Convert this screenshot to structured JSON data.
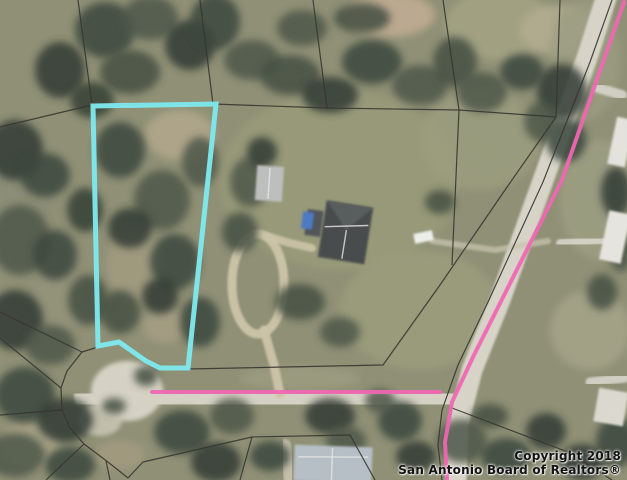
{
  "canvas": {
    "width": 627,
    "height": 480
  },
  "colors": {
    "terrain_base": "#8e8f74",
    "subject_lot_outline": "#7de9ee",
    "road_highlight": "#f264b4",
    "parcel_line": "#33332c",
    "credit_text": "#141414"
  },
  "credit": {
    "line1": "Copyright 2018",
    "line2": "San Antonio Board of Realtors®"
  },
  "terrain": {
    "base": "#8e8f74",
    "patches": [
      [
        390,
        15,
        45,
        22,
        "#c0ab92",
        0.9
      ],
      [
        500,
        25,
        55,
        35,
        "#a3a283",
        0.9
      ],
      [
        560,
        30,
        40,
        25,
        "#b5ad92",
        0.8
      ],
      [
        340,
        180,
        120,
        90,
        "#979a78",
        0.9
      ],
      [
        420,
        310,
        80,
        60,
        "#9a9c7c",
        0.85
      ],
      [
        480,
        140,
        60,
        50,
        "#9b9d7e",
        0.8
      ],
      [
        180,
        135,
        35,
        25,
        "#b3a78c",
        0.85
      ],
      [
        135,
        265,
        28,
        38,
        "#a29b80",
        0.8
      ],
      [
        165,
        325,
        22,
        18,
        "#a89f84",
        0.8
      ],
      [
        600,
        200,
        40,
        60,
        "#9c9e81",
        0.85
      ],
      [
        585,
        60,
        35,
        60,
        "#9a9c80",
        0.8
      ],
      [
        590,
        330,
        40,
        40,
        "#a5a387",
        0.85
      ],
      [
        30,
        445,
        30,
        25,
        "#b0a88c",
        0.7
      ],
      [
        120,
        455,
        25,
        15,
        "#ab9f84",
        0.6
      ],
      [
        25,
        190,
        30,
        40,
        "#8a8c74",
        0.9
      ],
      [
        60,
        300,
        25,
        30,
        "#94937a",
        0.8
      ],
      [
        300,
        378,
        60,
        12,
        "#9f9e82",
        0.7
      ]
    ],
    "tree_colors": [
      "#39443a",
      "#2e3730",
      "#4b5546",
      "#57604c",
      "#424d40",
      "#333d33",
      "#5f6852"
    ],
    "trees": [
      [
        15,
        150,
        28,
        30,
        1
      ],
      [
        45,
        175,
        25,
        22,
        0
      ],
      [
        20,
        240,
        30,
        35,
        2
      ],
      [
        55,
        255,
        22,
        25,
        0
      ],
      [
        15,
        320,
        28,
        30,
        1
      ],
      [
        50,
        345,
        25,
        20,
        2
      ],
      [
        25,
        395,
        30,
        28,
        0
      ],
      [
        65,
        420,
        28,
        22,
        1
      ],
      [
        15,
        455,
        30,
        22,
        2
      ],
      [
        70,
        465,
        25,
        18,
        0
      ],
      [
        88,
        300,
        20,
        25,
        4
      ],
      [
        85,
        210,
        18,
        22,
        5
      ],
      [
        105,
        30,
        30,
        28,
        0
      ],
      [
        150,
        18,
        28,
        22,
        2
      ],
      [
        190,
        45,
        25,
        25,
        1
      ],
      [
        130,
        72,
        30,
        22,
        4
      ],
      [
        215,
        22,
        25,
        28,
        0
      ],
      [
        252,
        60,
        28,
        20,
        2
      ],
      [
        60,
        70,
        25,
        28,
        1
      ],
      [
        92,
        100,
        22,
        18,
        5
      ],
      [
        290,
        75,
        30,
        20,
        4
      ],
      [
        330,
        95,
        28,
        18,
        1
      ],
      [
        372,
        62,
        30,
        22,
        0
      ],
      [
        420,
        85,
        28,
        20,
        2
      ],
      [
        455,
        62,
        22,
        25,
        4
      ],
      [
        302,
        28,
        25,
        18,
        2
      ],
      [
        362,
        18,
        28,
        15,
        4
      ],
      [
        120,
        150,
        25,
        28,
        0
      ],
      [
        162,
        200,
        28,
        30,
        2
      ],
      [
        130,
        228,
        22,
        20,
        1
      ],
      [
        175,
        262,
        25,
        28,
        0
      ],
      [
        120,
        312,
        20,
        22,
        4
      ],
      [
        160,
        296,
        18,
        18,
        1
      ],
      [
        200,
        162,
        18,
        25,
        2
      ],
      [
        200,
        322,
        20,
        25,
        0
      ],
      [
        250,
        182,
        20,
        25,
        2
      ],
      [
        240,
        232,
        18,
        20,
        4
      ],
      [
        300,
        302,
        25,
        18,
        4
      ],
      [
        340,
        332,
        20,
        15,
        2
      ],
      [
        262,
        152,
        15,
        15,
        1
      ],
      [
        440,
        202,
        15,
        12,
        4
      ],
      [
        482,
        92,
        25,
        20,
        2
      ],
      [
        522,
        72,
        22,
        18,
        0
      ],
      [
        562,
        92,
        25,
        28,
        1
      ],
      [
        566,
        140,
        20,
        22,
        0
      ],
      [
        542,
        122,
        18,
        20,
        2
      ],
      [
        616,
        192,
        15,
        25,
        1
      ],
      [
        621,
        252,
        12,
        20,
        2
      ],
      [
        602,
        292,
        15,
        18,
        4
      ],
      [
        616,
        442,
        20,
        25,
        0
      ],
      [
        582,
        462,
        22,
        18,
        1
      ],
      [
        182,
        432,
        28,
        22,
        0
      ],
      [
        232,
        416,
        22,
        18,
        2
      ],
      [
        216,
        462,
        25,
        20,
        1
      ],
      [
        270,
        456,
        20,
        15,
        0
      ],
      [
        330,
        416,
        25,
        18,
        1
      ],
      [
        346,
        441,
        20,
        15,
        2
      ],
      [
        400,
        421,
        22,
        20,
        0
      ],
      [
        416,
        456,
        20,
        15,
        1
      ],
      [
        462,
        441,
        25,
        22,
        2
      ],
      [
        506,
        456,
        25,
        18,
        0
      ],
      [
        546,
        431,
        20,
        18,
        1
      ],
      [
        490,
        416,
        18,
        12,
        4
      ],
      [
        380,
        401,
        15,
        12,
        2
      ],
      [
        146,
        376,
        12,
        10,
        4
      ],
      [
        114,
        406,
        12,
        8,
        4
      ]
    ]
  },
  "roads": {
    "bulbs": [
      {
        "cx": 127,
        "cy": 391,
        "rx": 36,
        "ry": 30,
        "fill": "#d6d2c4",
        "opacity": 1
      },
      {
        "cx": 100,
        "cy": 420,
        "rx": 22,
        "ry": 16,
        "fill": "#cfcaba",
        "opacity": 0.8
      }
    ],
    "strips": [
      {
        "points": [
          [
            96,
            396
          ],
          [
            240,
            396
          ],
          [
            370,
            398
          ],
          [
            446,
            402
          ]
        ],
        "width": 44,
        "color": "#d6d2c4",
        "opacity": 1
      },
      {
        "points": [
          [
            607,
            -5
          ],
          [
            588,
            55
          ],
          [
            545,
            175
          ],
          [
            500,
            300
          ],
          [
            472,
            370
          ],
          [
            458,
            425
          ],
          [
            456,
            482
          ]
        ],
        "width": 21,
        "color": "#d8d4c8",
        "opacity": 1
      },
      {
        "points": [
          [
            264,
            330
          ],
          [
            274,
            365
          ],
          [
            280,
            394
          ]
        ],
        "width": 9,
        "color": "#cdc5a9",
        "opacity": 0.95
      },
      {
        "points": [
          [
            266,
            236
          ],
          [
            290,
            243
          ],
          [
            312,
            248
          ]
        ],
        "width": 8,
        "color": "#cdc5a9",
        "opacity": 0.9
      },
      {
        "points": [
          [
            548,
            241
          ],
          [
            495,
            250
          ],
          [
            432,
            241
          ]
        ],
        "width": 6,
        "color": "#c9c3ae",
        "opacity": 0.75
      },
      {
        "points": [
          [
            598,
            88
          ],
          [
            622,
            95
          ]
        ],
        "width": 10,
        "color": "#d9d6cc",
        "opacity": 0.9
      },
      {
        "points": [
          [
            560,
            243
          ],
          [
            605,
            240
          ]
        ],
        "width": 8,
        "color": "#d9d6cc",
        "opacity": 0.9
      },
      {
        "points": [
          [
            590,
            382
          ],
          [
            625,
            378
          ]
        ],
        "width": 9,
        "color": "#d9d6cc",
        "opacity": 0.9
      },
      {
        "points": [
          [
            285,
            445
          ],
          [
            290,
            480
          ]
        ],
        "width": 12,
        "color": "#cfc8b4",
        "opacity": 0.85
      }
    ],
    "rings": [
      {
        "cx": 258,
        "cy": 284,
        "rx": 26,
        "ry": 50,
        "width": 9,
        "color": "#cdc5a9",
        "opacity": 0.95
      }
    ]
  },
  "buildings": [
    {
      "x": 256,
      "y": 166,
      "w": 27,
      "h": 35,
      "rot": 4,
      "fill": "#bdbfbe",
      "lines": [
        [
          13,
          2,
          13,
          33
        ]
      ]
    },
    {
      "x": 306,
      "y": 210,
      "w": 16,
      "h": 26,
      "rot": 8,
      "fill": "#505356",
      "lines": []
    },
    {
      "x": 302,
      "y": 212,
      "w": 11,
      "h": 17,
      "rot": 8,
      "fill": "#4c78c4",
      "lines": []
    },
    {
      "x": 322,
      "y": 204,
      "w": 47,
      "h": 57,
      "rot": 9,
      "fill": "#45484a",
      "facet": [
        [
          0,
          0
        ],
        [
          47,
          0
        ],
        [
          24,
          26
        ]
      ],
      "facet_fill": "#595d5f",
      "lines": [
        [
          2,
          26,
          45,
          18
        ],
        [
          24,
          26,
          24,
          55
        ]
      ]
    },
    {
      "x": 414,
      "y": 232,
      "w": 19,
      "h": 10,
      "rot": -12,
      "fill": "#eef0ec",
      "lines": []
    },
    {
      "x": 294,
      "y": 446,
      "w": 78,
      "h": 36,
      "rot": 2,
      "fill": "#b6bfc6",
      "lines": [
        [
          4,
          12,
          74,
          10
        ],
        [
          38,
          2,
          38,
          34
        ]
      ]
    },
    {
      "x": 612,
      "y": 118,
      "w": 18,
      "h": 48,
      "rot": 12,
      "fill": "#e4e3dd",
      "lines": []
    },
    {
      "x": 604,
      "y": 212,
      "w": 22,
      "h": 50,
      "rot": 12,
      "fill": "#e6e5df",
      "lines": []
    },
    {
      "x": 596,
      "y": 390,
      "w": 30,
      "h": 34,
      "rot": 10,
      "fill": "#dcdad0",
      "lines": []
    }
  ],
  "parcel_lines": {
    "color": "#33332c",
    "width": 1.2,
    "opacity": 0.9,
    "lines": [
      [
        [
          78,
          0
        ],
        [
          92,
          105
        ]
      ],
      [
        [
          0,
          127
        ],
        [
          92,
          105
        ],
        [
          213,
          104
        ],
        [
          327,
          108
        ],
        [
          459,
          110
        ],
        [
          556,
          117
        ]
      ],
      [
        [
          200,
          0
        ],
        [
          213,
          104
        ]
      ],
      [
        [
          313,
          0
        ],
        [
          327,
          108
        ]
      ],
      [
        [
          443,
          0
        ],
        [
          459,
          110
        ]
      ],
      [
        [
          560,
          0
        ],
        [
          556,
          117
        ]
      ],
      [
        [
          612,
          0
        ],
        [
          590,
          62
        ],
        [
          543,
          182
        ],
        [
          488,
          302
        ],
        [
          458,
          365
        ],
        [
          442,
          410
        ],
        [
          438,
          445
        ],
        [
          442,
          480
        ]
      ],
      [
        [
          556,
          117
        ],
        [
          505,
          190
        ],
        [
          440,
          285
        ],
        [
          383,
          365
        ],
        [
          188,
          369
        ]
      ],
      [
        [
          459,
          110
        ],
        [
          452,
          265
        ]
      ],
      [
        [
          98,
          347
        ],
        [
          82,
          352
        ],
        [
          67,
          371
        ],
        [
          61,
          388
        ],
        [
          62,
          410
        ],
        [
          70,
          428
        ],
        [
          84,
          444
        ],
        [
          104,
          459
        ],
        [
          118,
          470
        ],
        [
          128,
          478
        ]
      ],
      [
        [
          0,
          312
        ],
        [
          82,
          352
        ]
      ],
      [
        [
          0,
          338
        ],
        [
          61,
          388
        ]
      ],
      [
        [
          0,
          415
        ],
        [
          62,
          410
        ]
      ],
      [
        [
          84,
          444
        ],
        [
          46,
          480
        ]
      ],
      [
        [
          106,
          461
        ],
        [
          110,
          480
        ]
      ],
      [
        [
          128,
          478
        ],
        [
          143,
          462
        ],
        [
          252,
          437
        ],
        [
          350,
          435
        ],
        [
          375,
          480
        ]
      ],
      [
        [
          252,
          437
        ],
        [
          240,
          480
        ]
      ],
      [
        [
          452,
          408
        ],
        [
          568,
          452
        ],
        [
          612,
          480
        ]
      ]
    ]
  },
  "subject_lot": {
    "points": [
      [
        93,
        106
      ],
      [
        216,
        104
      ],
      [
        188,
        368
      ],
      [
        160,
        368
      ],
      [
        146,
        361
      ],
      [
        119,
        342
      ],
      [
        98,
        346
      ]
    ],
    "color": "#7de9ee",
    "width": 5
  },
  "road_highlights": {
    "color": "#f264b4",
    "width": 4,
    "lines": [
      [
        [
          152,
          392
        ],
        [
          440,
          392
        ]
      ],
      [
        [
          624,
          2
        ],
        [
          562,
          180
        ],
        [
          474,
          355
        ],
        [
          452,
          402
        ],
        [
          445,
          442
        ],
        [
          447,
          480
        ]
      ]
    ]
  }
}
